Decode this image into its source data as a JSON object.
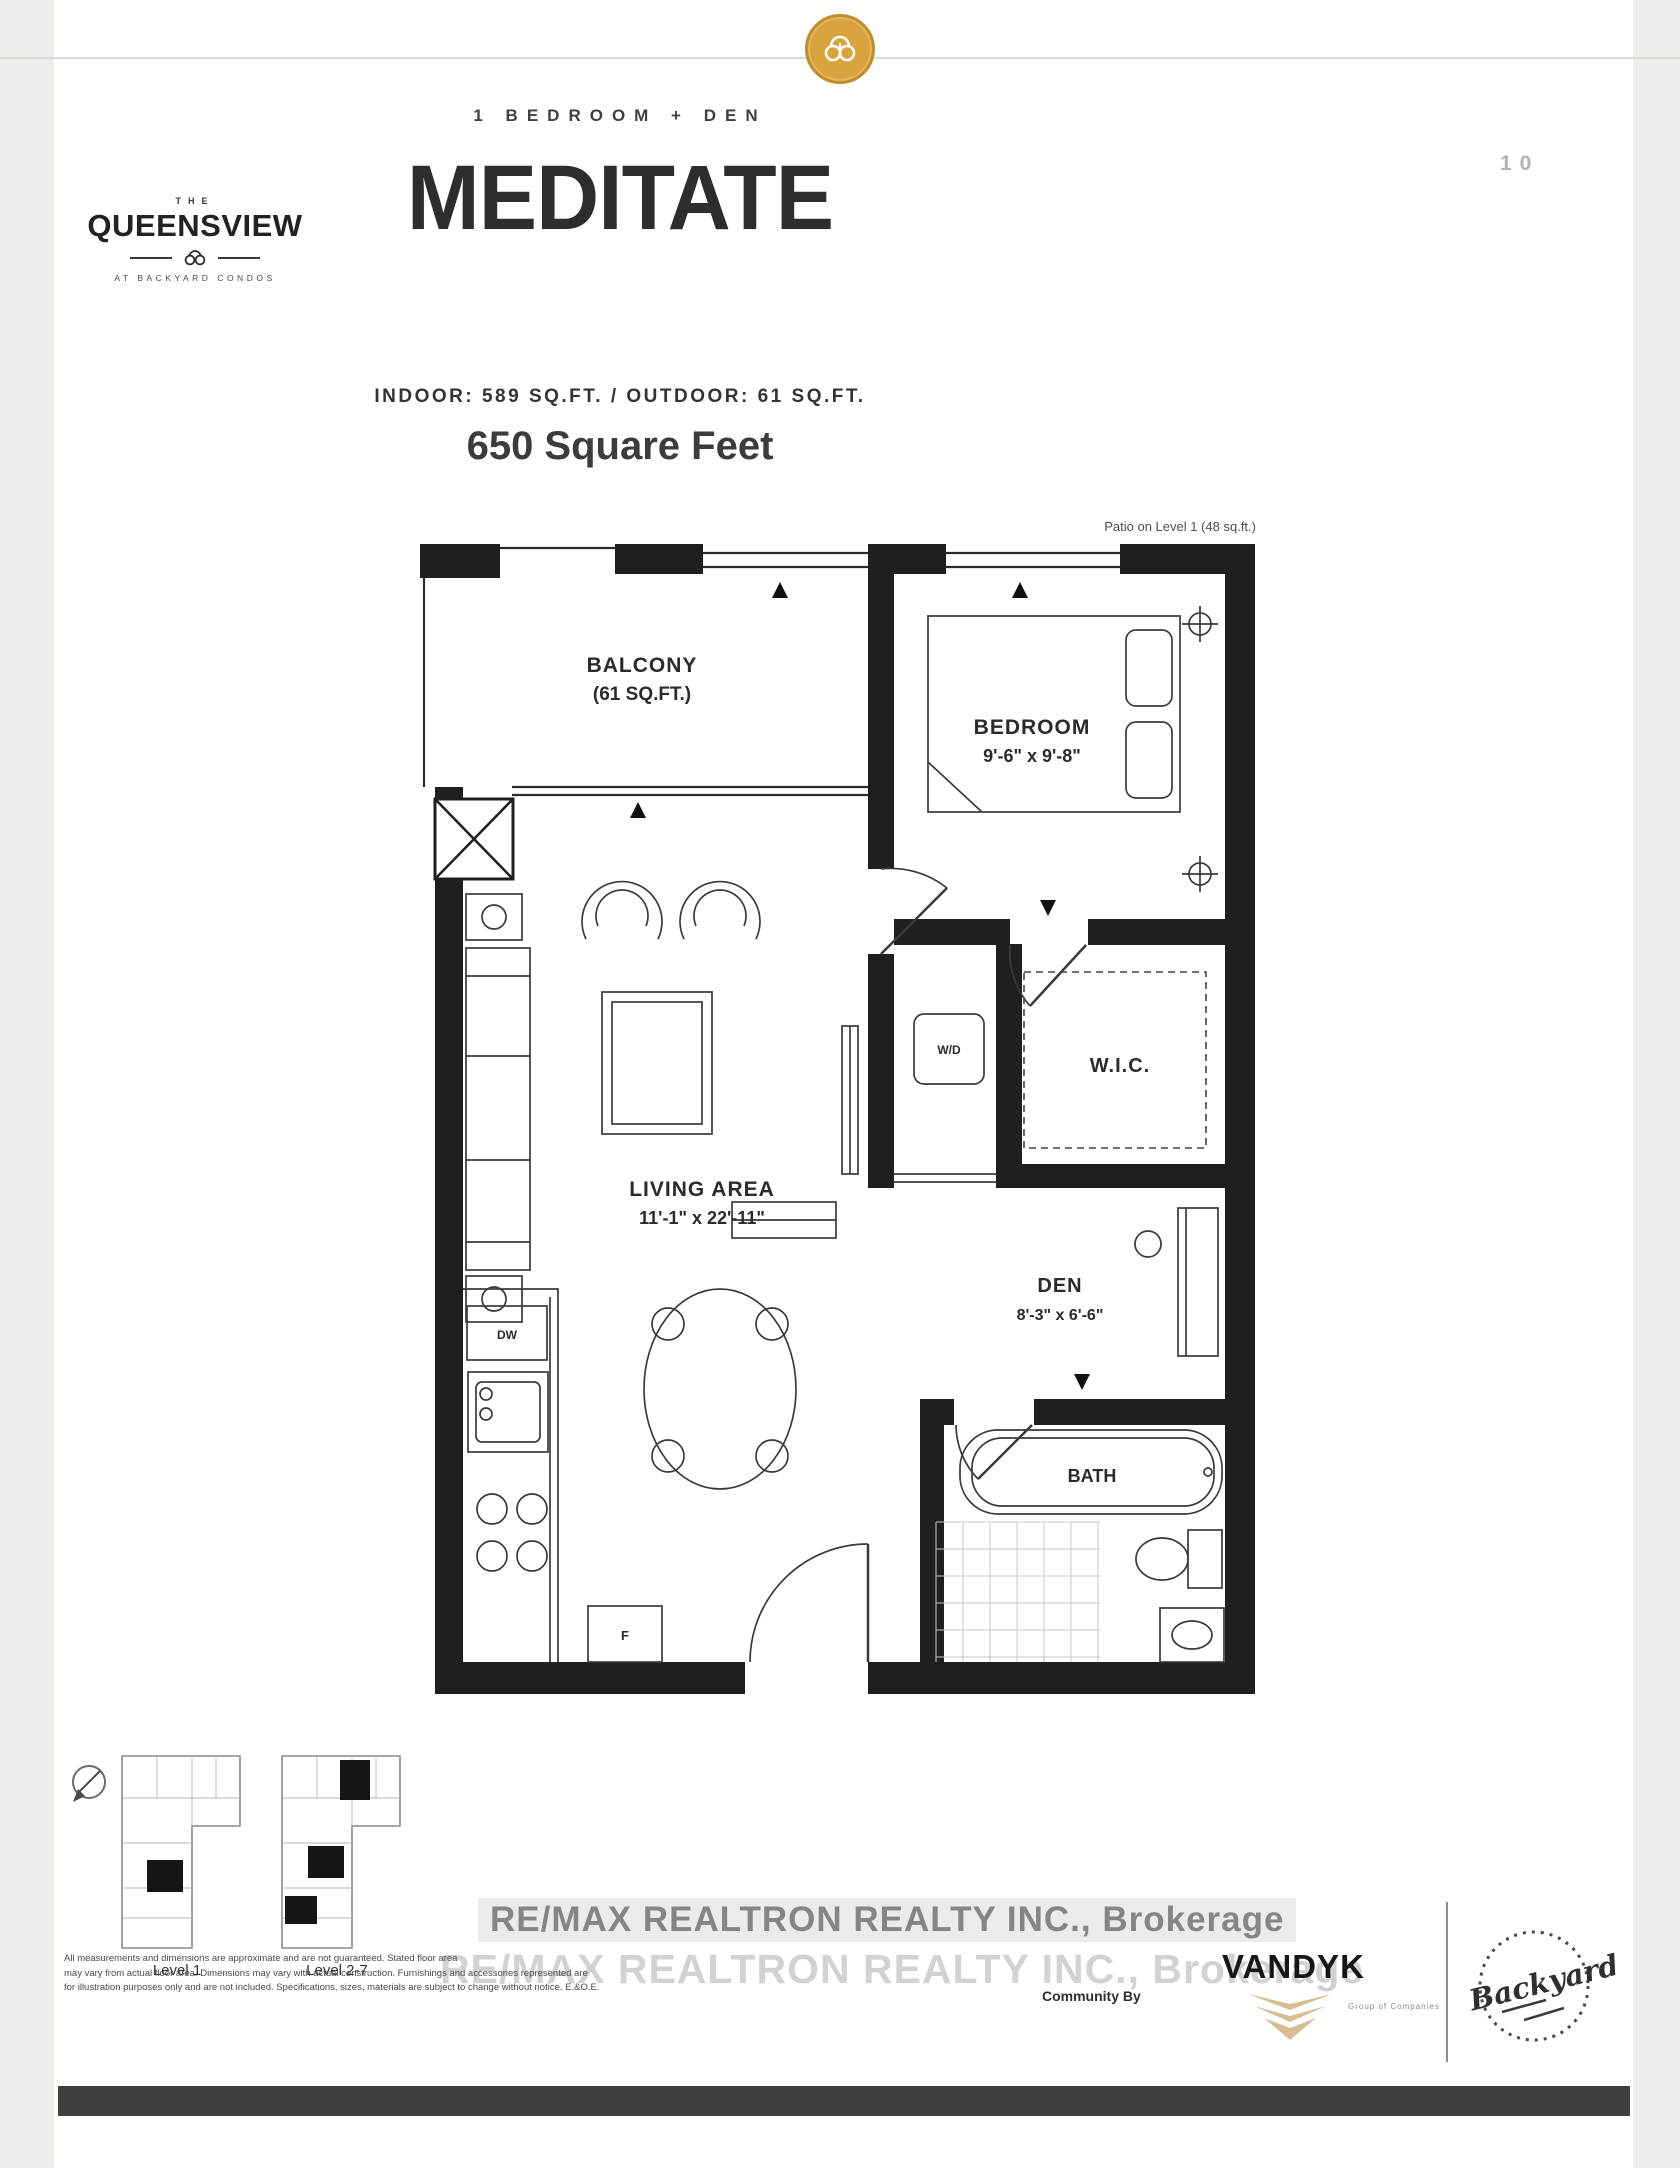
{
  "header": {
    "unit_type": "1 BEDROOM + DEN",
    "page_number": "10",
    "unit_name": "MEDITATE",
    "area_line": "INDOOR: 589 SQ.FT. / OUTDOOR: 61 SQ.FT.",
    "total_area": "650 Square Feet"
  },
  "brand": {
    "the": "THE",
    "name": "QUEENSVIEW",
    "tagline": "AT BACKYARD CONDOS"
  },
  "floorplan": {
    "patio_note": "Patio on Level 1 (48 sq.ft.)",
    "rooms": {
      "balcony": {
        "name": "BALCONY",
        "dims": "(61 SQ.FT.)"
      },
      "bedroom": {
        "name": "BEDROOM",
        "dims": "9'-6\" x 9'-8\""
      },
      "wic": {
        "name": "W.I.C."
      },
      "wd": {
        "name": "W/D"
      },
      "living": {
        "name": "LIVING AREA",
        "dims": "11'-1\" x 22'-11\""
      },
      "den": {
        "name": "DEN",
        "dims": "8'-3\" x 6'-6\""
      },
      "bath": {
        "name": "BATH"
      }
    },
    "appliances": {
      "dishwasher": "DW",
      "fridge": "F"
    }
  },
  "keyplans": {
    "level1": "Level 1",
    "level27": "Level 2-7"
  },
  "footer": {
    "watermark_line1": "RE/MAX REALTRON REALTY INC., Brokerage",
    "watermark_line2": "RE/MAX REALTRON REALTY INC., Brokerage",
    "community_by": "Community By",
    "vandyk": "VANDYK",
    "vandyk_tagline": "Group of Companies",
    "backyard": "Backyard",
    "disclaimer_line1": "All measurements and dimensions are approximate and are not guaranteed. Stated floor area",
    "disclaimer_line2": "may vary from actual floor area. Dimensions may vary with actual construction. Furnishings and accessories represented are",
    "disclaimer_line3": "for illustration purposes only and are not included. Specifications, sizes, materials are subject to change without notice. E.&O.E."
  },
  "colors": {
    "badge_gold": "#d9a43f",
    "vandyk_tan": "#d8bd92",
    "wall_black": "#1f1f1f",
    "bottom_bar": "#3e3e3e"
  }
}
